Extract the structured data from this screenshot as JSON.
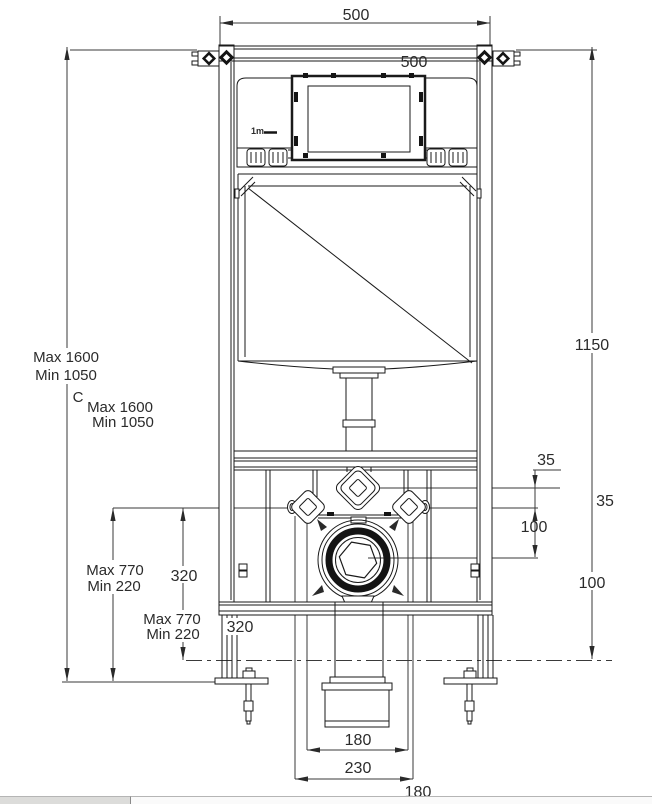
{
  "drawing": {
    "kind": "concealed-cistern-installation-frame",
    "brand": "1m"
  },
  "labels": {
    "width_top": "500",
    "width_inner": "500",
    "height_overall": "1150",
    "install_max_a": "Max 1600",
    "install_min_a": "Min 1050",
    "section_c": "C",
    "install_max_b": "Max 1600",
    "install_min_b": "Min 1050",
    "inlet_offset_a": "35",
    "inlet_offset_b": "35",
    "outlet_offset_a": "100",
    "outlet_offset_b": "100",
    "bracket_max_a": "Max 770",
    "bracket_min_a": "Min 220",
    "elbow_height_a": "320",
    "bracket_max_b": "Max 770",
    "bracket_min_b": "Min 220",
    "elbow_height_b": "320",
    "fixing_span_a": "180",
    "pipe_span": "230",
    "fixing_span_b": "180",
    "brand": "1m"
  },
  "colors": {
    "line": "#1a1a1a",
    "dimension_line": "#3a3a3a",
    "text": "#2b2b2b",
    "background": "#ffffff",
    "strip_left": "#dcdcda",
    "strip_right": "#fafafa"
  }
}
